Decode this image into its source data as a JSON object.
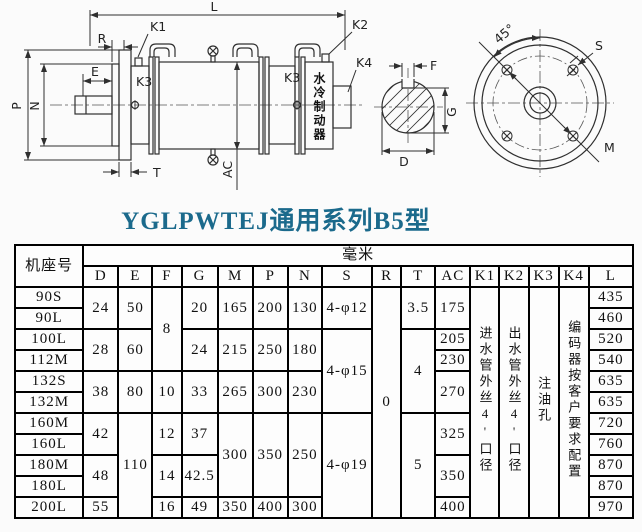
{
  "title": "YGLPWTEJ通用系列B5型",
  "accent_color": "#1b6a8c",
  "drawing": {
    "labels": {
      "L": "L",
      "R": "R",
      "K1": "K1",
      "K2": "K2",
      "K3": "K3",
      "K4": "K4",
      "E": "E",
      "P": "P",
      "N": "N",
      "T": "T",
      "AC": "AC",
      "F": "F",
      "G": "G",
      "D": "D",
      "angle": "45°",
      "S": "S",
      "M": "M",
      "brake": "水冷制动器"
    }
  },
  "table": {
    "frame_header": "机座号",
    "unit_header": "毫米",
    "columns": [
      "D",
      "E",
      "F",
      "G",
      "M",
      "P",
      "N",
      "S",
      "R",
      "T",
      "AC",
      "K1",
      "K2",
      "K3",
      "K4",
      "L"
    ],
    "rows": [
      [
        {
          "t": "机座号",
          "r": 2,
          "n": "frame-col-header"
        },
        {
          "t": "毫米",
          "c": 16,
          "n": "unit-header"
        }
      ],
      [
        {
          "t": "D",
          "n": "col-header-D"
        },
        {
          "t": "E",
          "n": "col-header-E"
        },
        {
          "t": "F",
          "n": "col-header-F"
        },
        {
          "t": "G",
          "n": "col-header-G"
        },
        {
          "t": "M",
          "n": "col-header-M"
        },
        {
          "t": "P",
          "n": "col-header-P"
        },
        {
          "t": "N",
          "n": "col-header-N"
        },
        {
          "t": "S",
          "n": "col-header-S"
        },
        {
          "t": "R",
          "n": "col-header-R"
        },
        {
          "t": "T",
          "n": "col-header-T"
        },
        {
          "t": "AC",
          "n": "col-header-AC"
        },
        {
          "t": "K1",
          "n": "col-header-K1"
        },
        {
          "t": "K2",
          "n": "col-header-K2"
        },
        {
          "t": "K3",
          "n": "col-header-K3"
        },
        {
          "t": "K4",
          "n": "col-header-K4"
        },
        {
          "t": "L",
          "n": "col-header-L"
        }
      ],
      [
        {
          "t": "90S",
          "n": "frame-size"
        },
        {
          "t": "24",
          "r": 2
        },
        {
          "t": "50",
          "r": 2
        },
        {
          "t": "8",
          "r": 4
        },
        {
          "t": "20",
          "r": 2
        },
        {
          "t": "165",
          "r": 2
        },
        {
          "t": "200",
          "r": 2
        },
        {
          "t": "130",
          "r": 2
        },
        {
          "t": "4-φ12",
          "r": 2
        },
        {
          "t": "0",
          "r": 11
        },
        {
          "t": "3.5",
          "r": 2
        },
        {
          "t": "175",
          "r": 2
        },
        {
          "t": "进水管外丝4'口径",
          "r": 11,
          "v": 1,
          "n": "k1-note"
        },
        {
          "t": "出水管外丝4'口径",
          "r": 11,
          "v": 1,
          "n": "k2-note"
        },
        {
          "t": "注油孔",
          "r": 11,
          "v": 1,
          "n": "k3-note"
        },
        {
          "t": "编码器按客户要求配置",
          "r": 11,
          "v": 1,
          "n": "k4-note"
        },
        {
          "t": "435"
        }
      ],
      [
        {
          "t": "90L",
          "n": "frame-size"
        },
        {
          "t": "460"
        }
      ],
      [
        {
          "t": "100L",
          "n": "frame-size"
        },
        {
          "t": "28",
          "r": 2
        },
        {
          "t": "60",
          "r": 2
        },
        {
          "t": "24",
          "r": 2
        },
        {
          "t": "215",
          "r": 2
        },
        {
          "t": "250",
          "r": 2
        },
        {
          "t": "180",
          "r": 2
        },
        {
          "t": "4-φ15",
          "r": 4
        },
        {
          "t": "4",
          "r": 4
        },
        {
          "t": "205"
        },
        {
          "t": "520"
        }
      ],
      [
        {
          "t": "112M",
          "n": "frame-size"
        },
        {
          "t": "230"
        },
        {
          "t": "540"
        }
      ],
      [
        {
          "t": "132S",
          "n": "frame-size"
        },
        {
          "t": "38",
          "r": 2
        },
        {
          "t": "80",
          "r": 2
        },
        {
          "t": "10",
          "r": 2
        },
        {
          "t": "33",
          "r": 2
        },
        {
          "t": "265",
          "r": 2
        },
        {
          "t": "300",
          "r": 2
        },
        {
          "t": "230",
          "r": 2
        },
        {
          "t": "270",
          "r": 2
        },
        {
          "t": "635"
        }
      ],
      [
        {
          "t": "132M",
          "n": "frame-size"
        },
        {
          "t": "635"
        }
      ],
      [
        {
          "t": "160M",
          "n": "frame-size"
        },
        {
          "t": "42",
          "r": 2
        },
        {
          "t": "110",
          "r": 5
        },
        {
          "t": "12",
          "r": 2
        },
        {
          "t": "37",
          "r": 2
        },
        {
          "t": "300",
          "r": 4
        },
        {
          "t": "350",
          "r": 4
        },
        {
          "t": "250",
          "r": 4
        },
        {
          "t": "4-φ19",
          "r": 5
        },
        {
          "t": "5",
          "r": 5
        },
        {
          "t": "325",
          "r": 2
        },
        {
          "t": "720"
        }
      ],
      [
        {
          "t": "160L",
          "n": "frame-size"
        },
        {
          "t": "760"
        }
      ],
      [
        {
          "t": "180M",
          "n": "frame-size"
        },
        {
          "t": "48",
          "r": 2
        },
        {
          "t": "14",
          "r": 2
        },
        {
          "t": "42.5",
          "r": 2
        },
        {
          "t": "350",
          "r": 2
        },
        {
          "t": "870"
        }
      ],
      [
        {
          "t": "180L",
          "n": "frame-size"
        },
        {
          "t": "870"
        }
      ],
      [
        {
          "t": "200L",
          "n": "frame-size"
        },
        {
          "t": "55"
        },
        {
          "t": "16"
        },
        {
          "t": "49"
        },
        {
          "t": "350"
        },
        {
          "t": "400"
        },
        {
          "t": "300"
        },
        {
          "t": "400"
        },
        {
          "t": "970"
        }
      ]
    ]
  }
}
